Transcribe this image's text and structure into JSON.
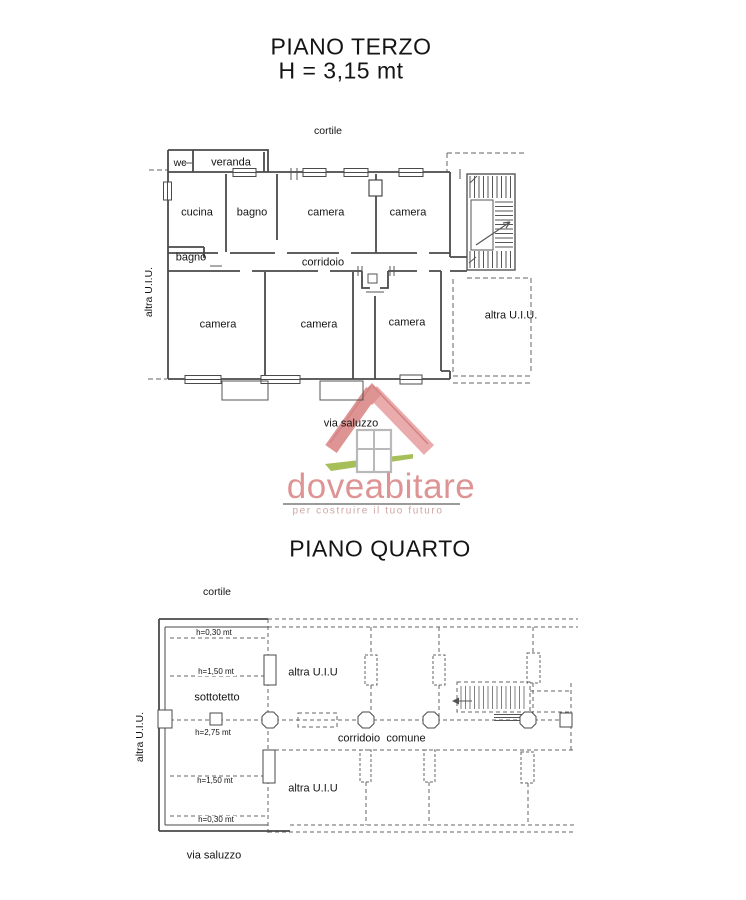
{
  "piano_terzo": {
    "title": "PIANO TERZO",
    "height_note": "H = 3,15 mt",
    "cortile_label": "cortile",
    "via_label": "via saluzzo",
    "altra_uiu_left": "altra U.I.U.",
    "altra_uiu_right": "altra U.I.U.",
    "rooms": {
      "wc": "wc",
      "veranda": "veranda",
      "cucina": "cucina",
      "bagno_top": "bagno",
      "camera_top_center": "camera",
      "camera_top_right": "camera",
      "bagno_left": "bagno",
      "corridoio": "corridoio",
      "camera_bottom_left": "camera",
      "camera_bottom_center": "camera",
      "camera_bottom_right": "camera"
    }
  },
  "logo": {
    "brand": "doveabitare",
    "tagline": "per costruire il tuo futuro",
    "icon": "house-icon",
    "colors": {
      "brand_pink": "#de9494",
      "tagline_pink": "#cfa4a4",
      "roof_left": "#df9494",
      "roof_right": "#e9abab",
      "roof_edge": "#d48484",
      "window_gray": "#b9b9b9",
      "ground_green": "#a7bf58",
      "rule_gray": "#9b9b9b"
    }
  },
  "piano_quarto": {
    "title": "PIANO QUARTO",
    "cortile_label": "cortile",
    "via_label": "via saluzzo",
    "altra_uiu_left": "altra U.I.U.",
    "labels": {
      "h_030_top": "h=0,30 mt",
      "h_150_top": "h=1,50 mt",
      "sottotetto": "sottotetto",
      "altra_uiu_top": "altra U.I.U",
      "h_275": "h=2,75 mt",
      "corridoio": "corridoio",
      "comune": "comune",
      "h_150_bottom": "h=1,50 mt",
      "altra_uiu_bottom": "altra U.I.U",
      "h_030_bottom": "h=0,30 mt"
    }
  }
}
